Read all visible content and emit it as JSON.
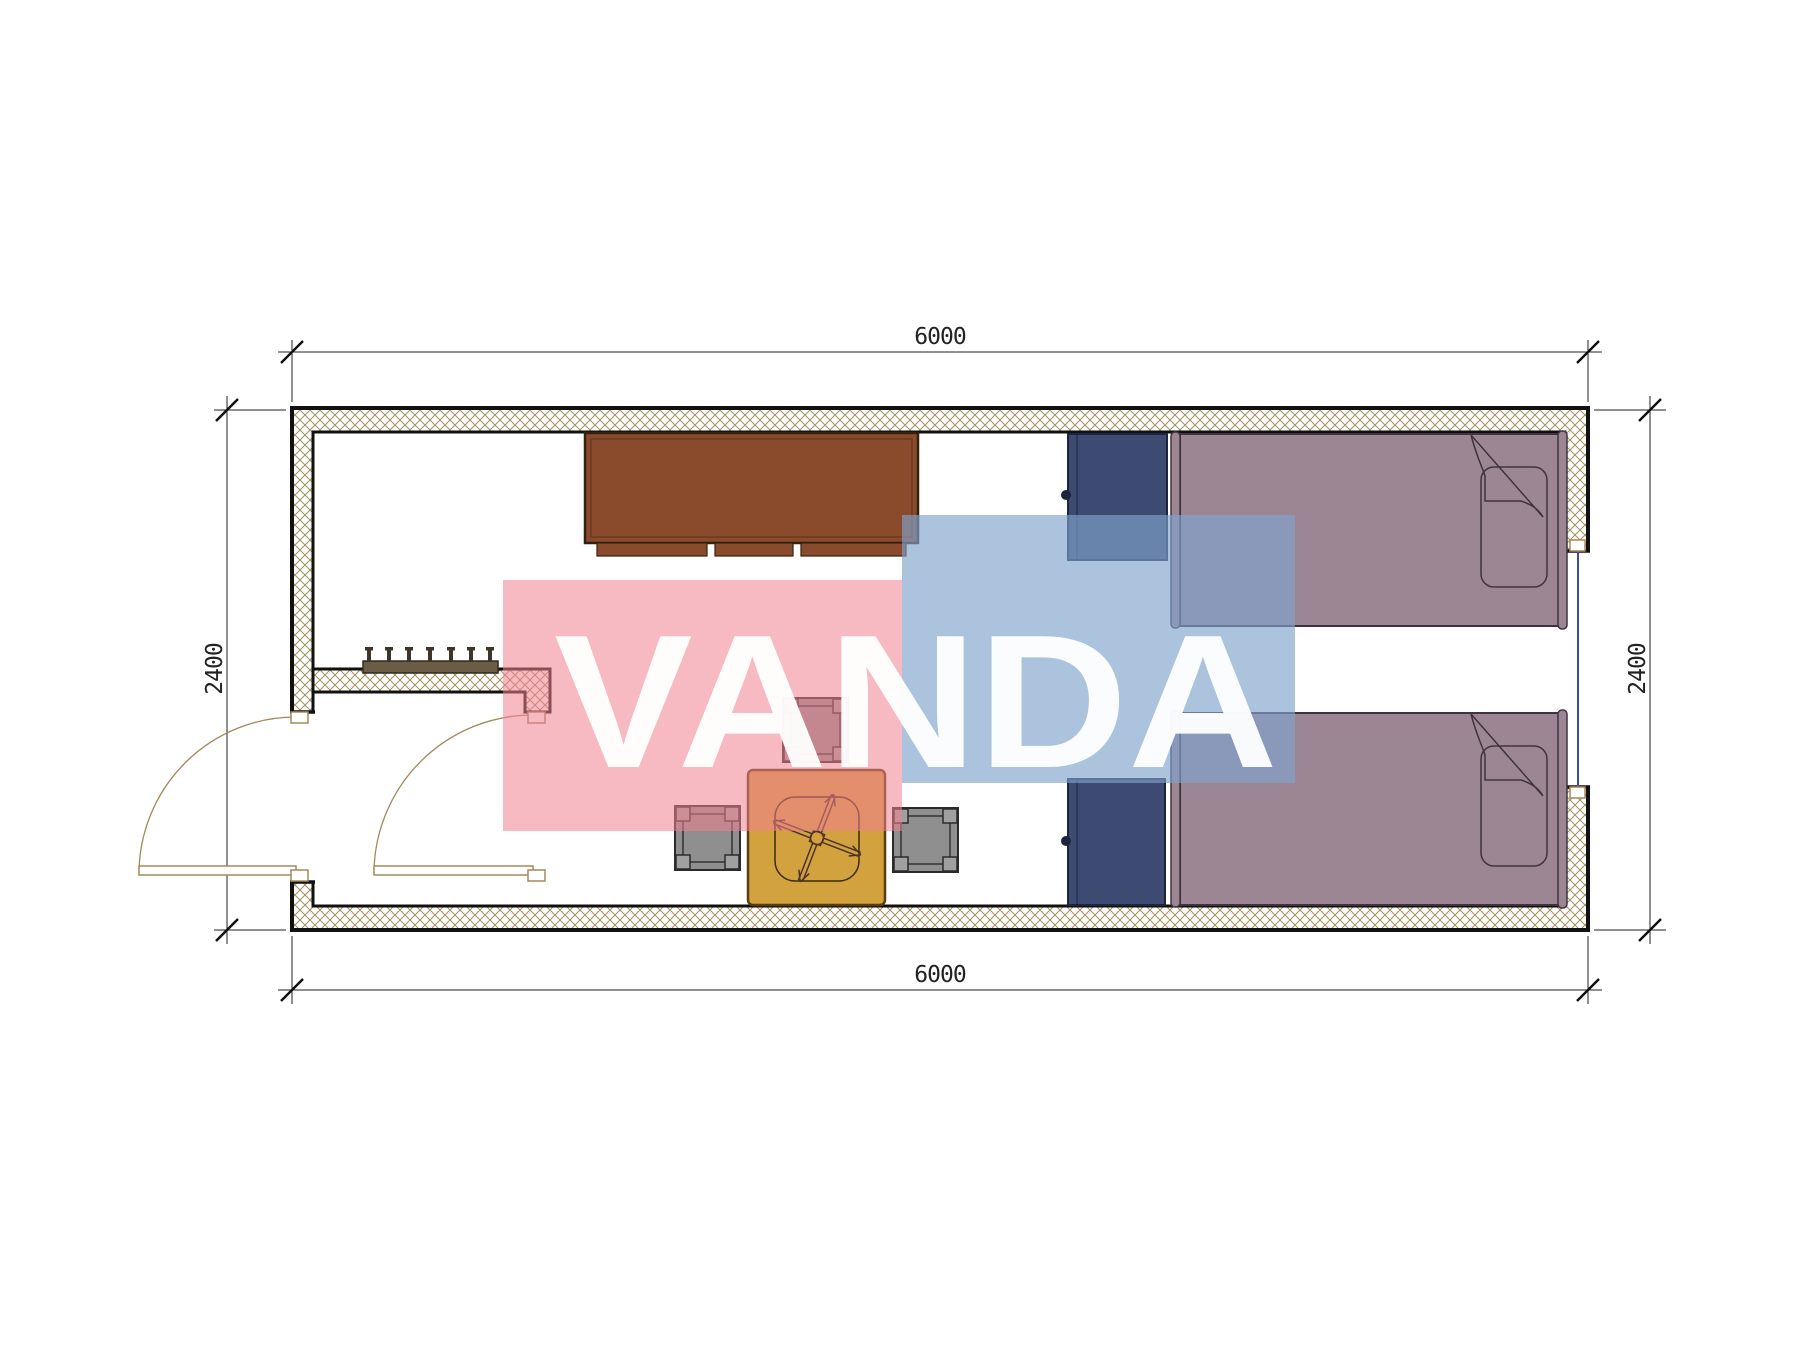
{
  "watermark": {
    "text": "VANDA",
    "pink_color": "#f0808f",
    "blue_color": "#80a3cd",
    "text_color": "#ffffff"
  },
  "dimensions": {
    "top": "6000",
    "bottom": "6000",
    "left": "2400",
    "right": "2400"
  },
  "plan": {
    "type": "floor-plan",
    "module_length_mm": 6000,
    "module_depth_mm": 2400,
    "furniture": [
      "storage-cabinet",
      "coat-rack-with-hooks",
      "entry-door-swing",
      "interior-door-swing",
      "window",
      "wardrobe-upper",
      "wardrobe-lower",
      "single-bed-with-pillow-upper",
      "single-bed-with-pillow-lower",
      "square-table-with-fan",
      "stool-left",
      "stool-top",
      "stool-right"
    ]
  },
  "colors": {
    "wall_hatch": "#a3905f",
    "wall_outline": "#111111",
    "cabinet": "#8a4a2c",
    "cabinet_outline": "#33210f",
    "wardrobe": "#3d4a72",
    "wardrobe_outline": "#1c2440",
    "bed": "#9d8694",
    "bed_outline": "#3f3340",
    "table": "#d2a23f",
    "table_outline": "#5a3c10",
    "stool": "#8f8f8f",
    "stool_outline": "#2b2b2b",
    "door_swing": "#a5895a",
    "window_glass": "#3b4aa6",
    "dimension_lines": "#222222",
    "coat_rack": "#6b5d45"
  }
}
